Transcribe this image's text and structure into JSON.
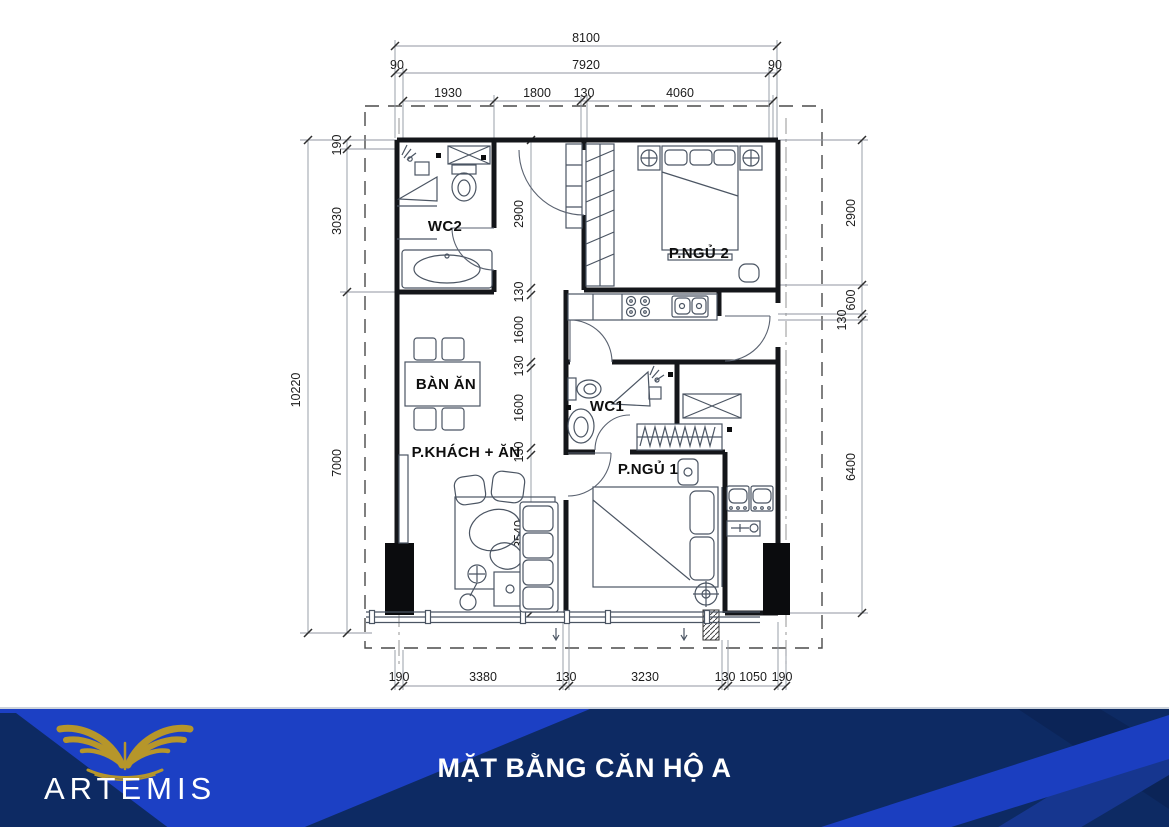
{
  "plan": {
    "rooms": {
      "wc2": "WC2",
      "bedroom2": "P.NGỦ 2",
      "dining": "BÀN ĂN",
      "living": "P.KHÁCH + ĂN",
      "wc1": "WC1",
      "bedroom1": "P.NGỦ 1"
    },
    "dims": {
      "top_total": "8100",
      "top_row2": [
        "90",
        "7920",
        "90"
      ],
      "top_row3": [
        "1930",
        "1800",
        "130",
        "4060"
      ],
      "left_total": "10220",
      "left_chain": [
        "190",
        "3030",
        "7000"
      ],
      "right_chain": [
        "2900",
        "600",
        "130",
        "6400"
      ],
      "mid_chain": [
        "2900",
        "130",
        "1600",
        "130",
        "1600",
        "130",
        "3540"
      ],
      "bottom_chain": [
        "190",
        "3380",
        "130",
        "3230",
        "130",
        "1050",
        "190"
      ]
    }
  },
  "footer": {
    "brand": "ARTEMIS",
    "title": "MẶT BẰNG CĂN HỘ A",
    "colors": {
      "base_navy": "#0d2a63",
      "bright_blue": "#1c40c4",
      "ribbon_blue": "#1b3ec0",
      "dark_band": "#0b2457",
      "gold": "#b6962a"
    }
  }
}
